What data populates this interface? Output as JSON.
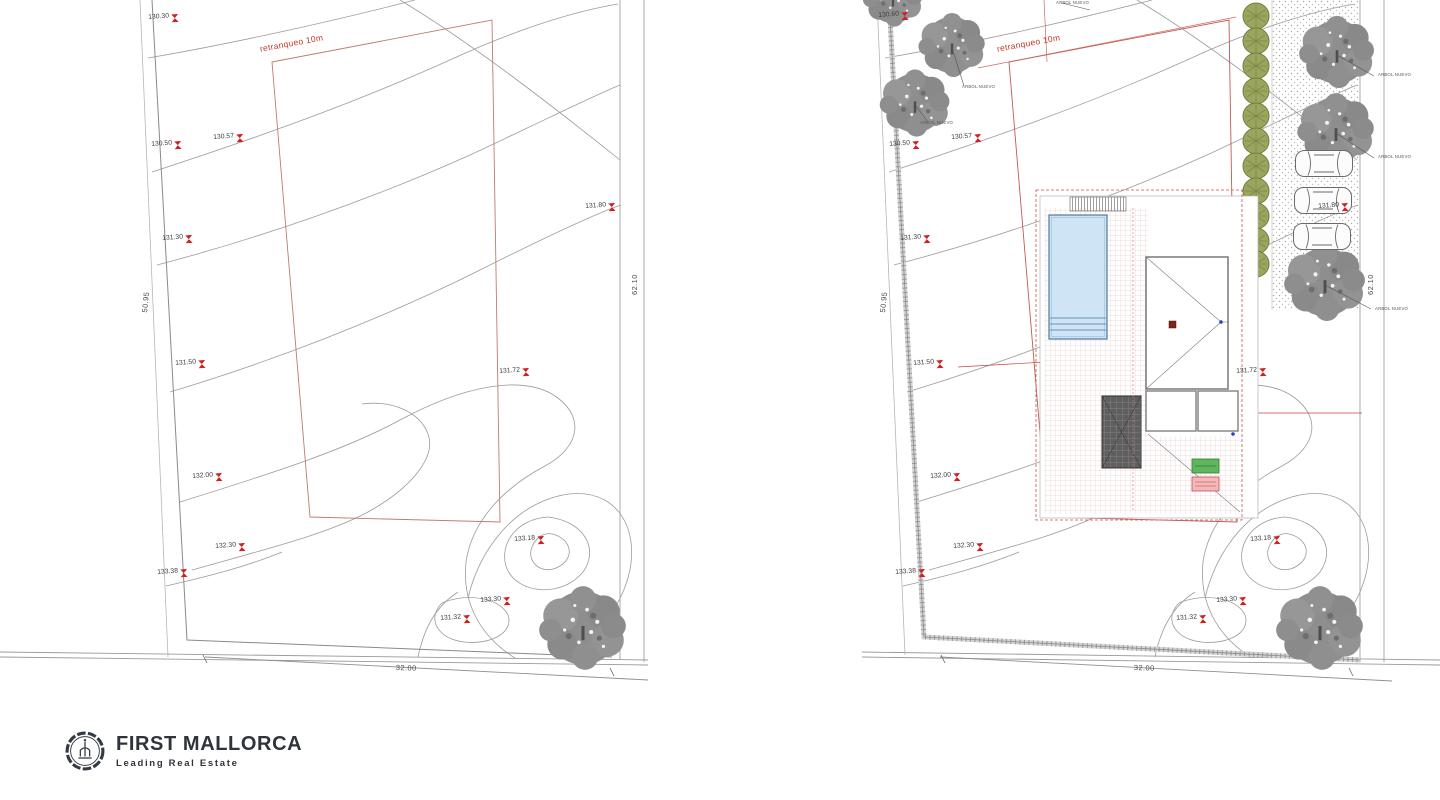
{
  "colors": {
    "contour": "#9b9b9b",
    "boundary": "#8f8f8f",
    "setback_red": "#bd7d6d",
    "label_red": "#c0392b",
    "marker_red": "#cc2222",
    "tree_gray": "#8d8d8d",
    "hedge_green": "#9aa65f",
    "pool_fill": "#cfe4f4",
    "pool_stroke": "#4a7b9d",
    "grid_pink": "#d8a8a8",
    "green_box": "#5fb65f",
    "pink_box": "#f3b9b9",
    "logo_dark": "#2f343c"
  },
  "setback_labels": [
    {
      "label": "retranqueo 10m",
      "x": 259,
      "y": 44,
      "rot": -10.5
    },
    {
      "label": "retranqueo 10m",
      "x": 996,
      "y": 44,
      "rot": -10.5
    }
  ],
  "dims": [
    {
      "label": "50.95",
      "x": 140,
      "y": 312,
      "rot": -84
    },
    {
      "label": "62.10",
      "x": 630,
      "y": 295,
      "rot": -90
    },
    {
      "label": "32.00",
      "x": 396,
      "y": 663,
      "rot": 2
    },
    {
      "label": "50.95",
      "x": 878,
      "y": 312,
      "rot": -84
    },
    {
      "label": "62.10",
      "x": 1366,
      "y": 295,
      "rot": -90
    },
    {
      "label": "32.00",
      "x": 1134,
      "y": 663,
      "rot": 2
    }
  ],
  "markers_left": [
    {
      "label": "130.30",
      "x": 148,
      "y": 14
    },
    {
      "label": "130.50",
      "x": 151,
      "y": 141
    },
    {
      "label": "130.57",
      "x": 213,
      "y": 134
    },
    {
      "label": "131.30",
      "x": 162,
      "y": 235
    },
    {
      "label": "131.50",
      "x": 175,
      "y": 360
    },
    {
      "label": "132.00",
      "x": 192,
      "y": 473
    },
    {
      "label": "132.30",
      "x": 215,
      "y": 543
    },
    {
      "label": "133.38",
      "x": 157,
      "y": 569
    },
    {
      "label": "131.80",
      "x": 585,
      "y": 203
    },
    {
      "label": "131.72",
      "x": 499,
      "y": 368
    },
    {
      "label": "133.18",
      "x": 514,
      "y": 536
    },
    {
      "label": "133.30",
      "x": 480,
      "y": 597
    },
    {
      "label": "131.32",
      "x": 440,
      "y": 615
    }
  ],
  "markers_right": [
    {
      "label": "130.60",
      "x": 878,
      "y": 12
    },
    {
      "label": "130.50",
      "x": 889,
      "y": 141
    },
    {
      "label": "130.57",
      "x": 951,
      "y": 134
    },
    {
      "label": "131.30",
      "x": 900,
      "y": 235
    },
    {
      "label": "131.50",
      "x": 913,
      "y": 360
    },
    {
      "label": "132.00",
      "x": 930,
      "y": 473
    },
    {
      "label": "132.30",
      "x": 953,
      "y": 543
    },
    {
      "label": "133.38",
      "x": 895,
      "y": 569
    },
    {
      "label": "131.80",
      "x": 1318,
      "y": 203
    },
    {
      "label": "131.72",
      "x": 1236,
      "y": 368
    },
    {
      "label": "133.18",
      "x": 1250,
      "y": 536
    },
    {
      "label": "133.30",
      "x": 1216,
      "y": 597
    },
    {
      "label": "131.32",
      "x": 1176,
      "y": 615
    }
  ],
  "tree_labels": [
    {
      "label": "ARBOL NUEVO",
      "x": 1056,
      "y": 0
    },
    {
      "label": "ARBOL NUEVO",
      "x": 962,
      "y": 84
    },
    {
      "label": "ARBOL NUEVO",
      "x": 920,
      "y": 120
    },
    {
      "label": "ARBOL NUEVO",
      "x": 1378,
      "y": 72
    },
    {
      "label": "ARBOL NUEVO",
      "x": 1378,
      "y": 154
    },
    {
      "label": "ARBOL NUEVO",
      "x": 1375,
      "y": 306
    }
  ],
  "logo": {
    "brand": "FIRST MALLORCA",
    "tagline": "Leading Real Estate"
  }
}
